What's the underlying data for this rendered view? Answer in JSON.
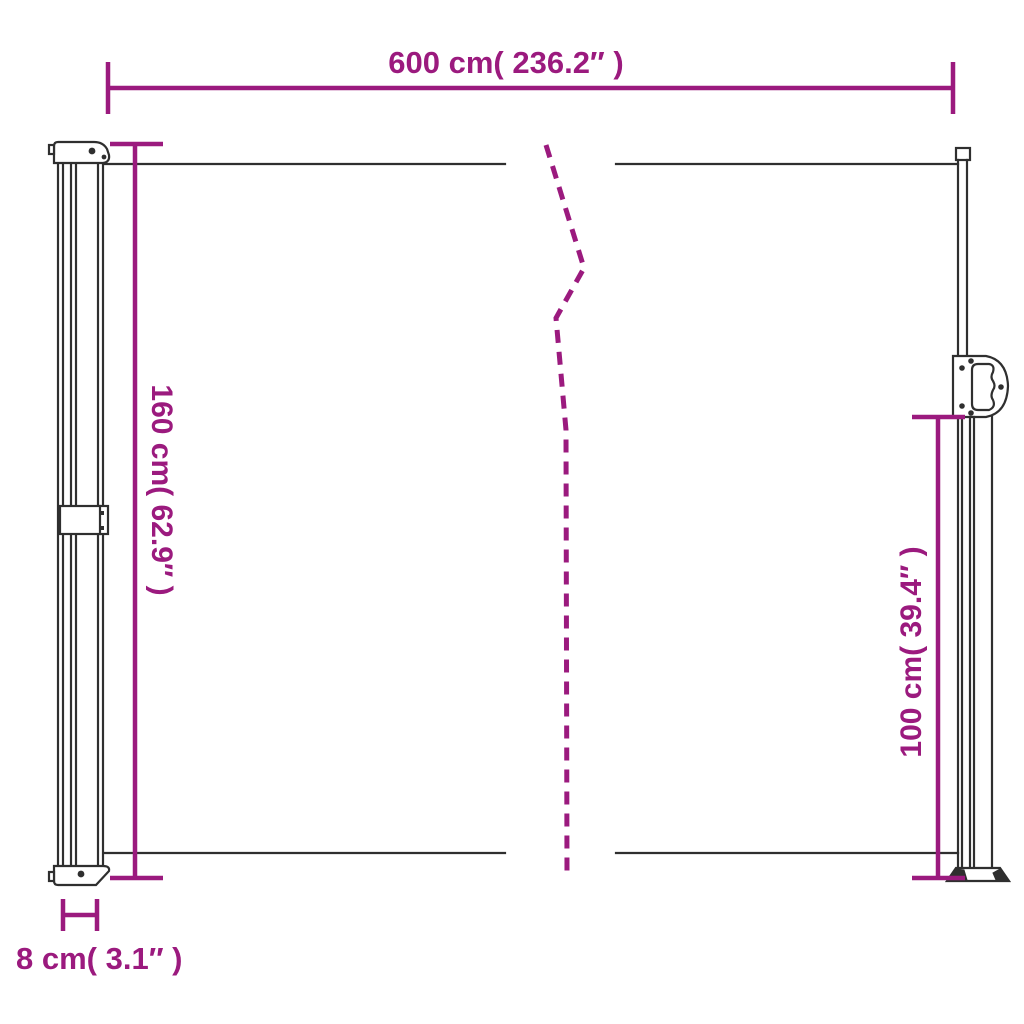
{
  "colors": {
    "accent": "#9B1A7E",
    "line": "#2F2F2F",
    "background": "#FFFFFF"
  },
  "dimensions": {
    "width": {
      "label": "600 cm( 236.2″ )"
    },
    "height_left": {
      "label": "160 cm( 62.9″ )"
    },
    "height_right": {
      "label": "100 cm( 39.4″ )"
    },
    "depth": {
      "label": "8 cm( 3.1″ )"
    }
  }
}
